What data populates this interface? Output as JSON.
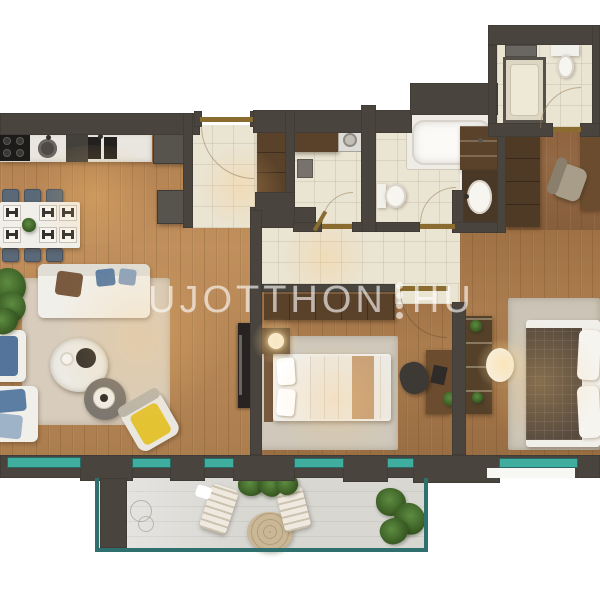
{
  "watermark": {
    "text_left": "UJOTTHON",
    "text_right": "HU",
    "separator": "four-vertical-dots"
  },
  "colors": {
    "wall": "#4a443e",
    "wood": "#b1834f",
    "tile": "#eae4d3",
    "balcony": "#d8d7d2",
    "glass": "#3fae9f",
    "glassframe": "#2f6f6d",
    "door": "#8b6c30",
    "cabinet": "#5a4129",
    "accent_yellow": "#e3c332",
    "accent_blue": "#5d7ea3",
    "watermark": "rgba(255,255,255,0.62)"
  }
}
